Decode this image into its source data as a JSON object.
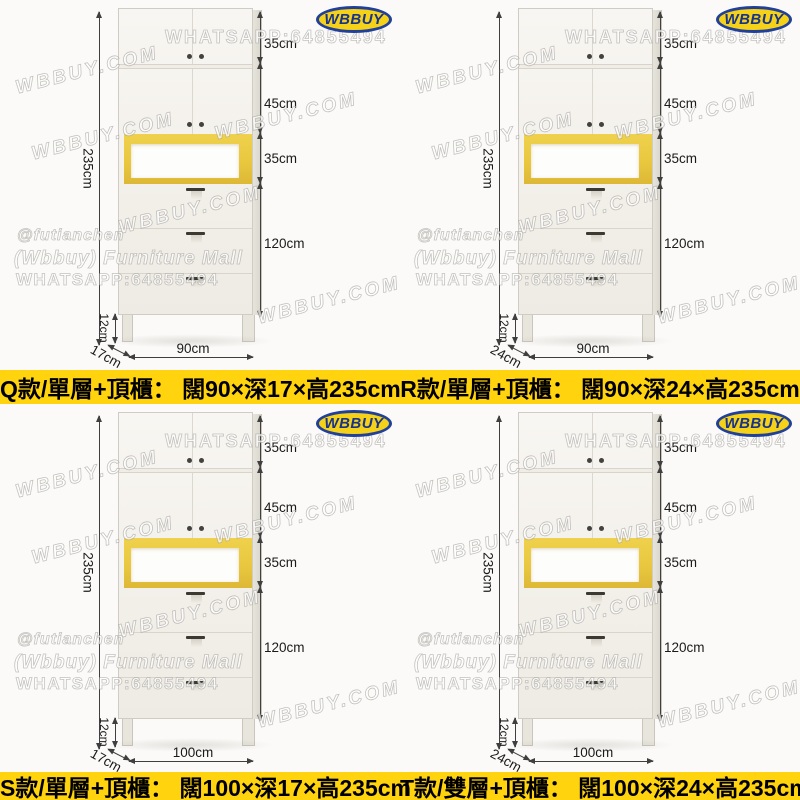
{
  "logo": {
    "text": "WBBUY"
  },
  "watermarks": {
    "whatsapp_large": "WHATSAPP:64855494",
    "site": "WBBUY.COM",
    "handle": "@futianchen",
    "mall": "(Wbbuy) Furniture Mall",
    "whatsapp_small": "WHATSAPP:64855494"
  },
  "dims": {
    "top_cabinet": "35cm",
    "upper_cabinet": "45cm",
    "open_shelf": "35cm",
    "drawer_section": "120cm",
    "total_height": "235cm",
    "leg_height": "12cm"
  },
  "variants": [
    {
      "model": "Q",
      "width_label": "90cm",
      "depth_label": "17cm",
      "caption": "Q款/單層+頂櫃： 闊90×深17×高235cm"
    },
    {
      "model": "R",
      "width_label": "90cm",
      "depth_label": "24cm",
      "caption": "R款/單層+頂櫃： 闊90×深24×高235cm"
    },
    {
      "model": "S",
      "width_label": "100cm",
      "depth_label": "17cm",
      "caption": "S款/單層+頂櫃： 闊100×深17×高235cm"
    },
    {
      "model": "T",
      "width_label": "100cm",
      "depth_label": "24cm",
      "caption": "T款/雙層+頂櫃： 闊100×深24×高235cm"
    }
  ],
  "colors": {
    "caption_bg": "#FFD30D",
    "accent_yellow": "#E9C83F",
    "logo_blue": "#20409A",
    "logo_yellow": "#F5D118",
    "cabinet_face": "#F3F0EA"
  }
}
